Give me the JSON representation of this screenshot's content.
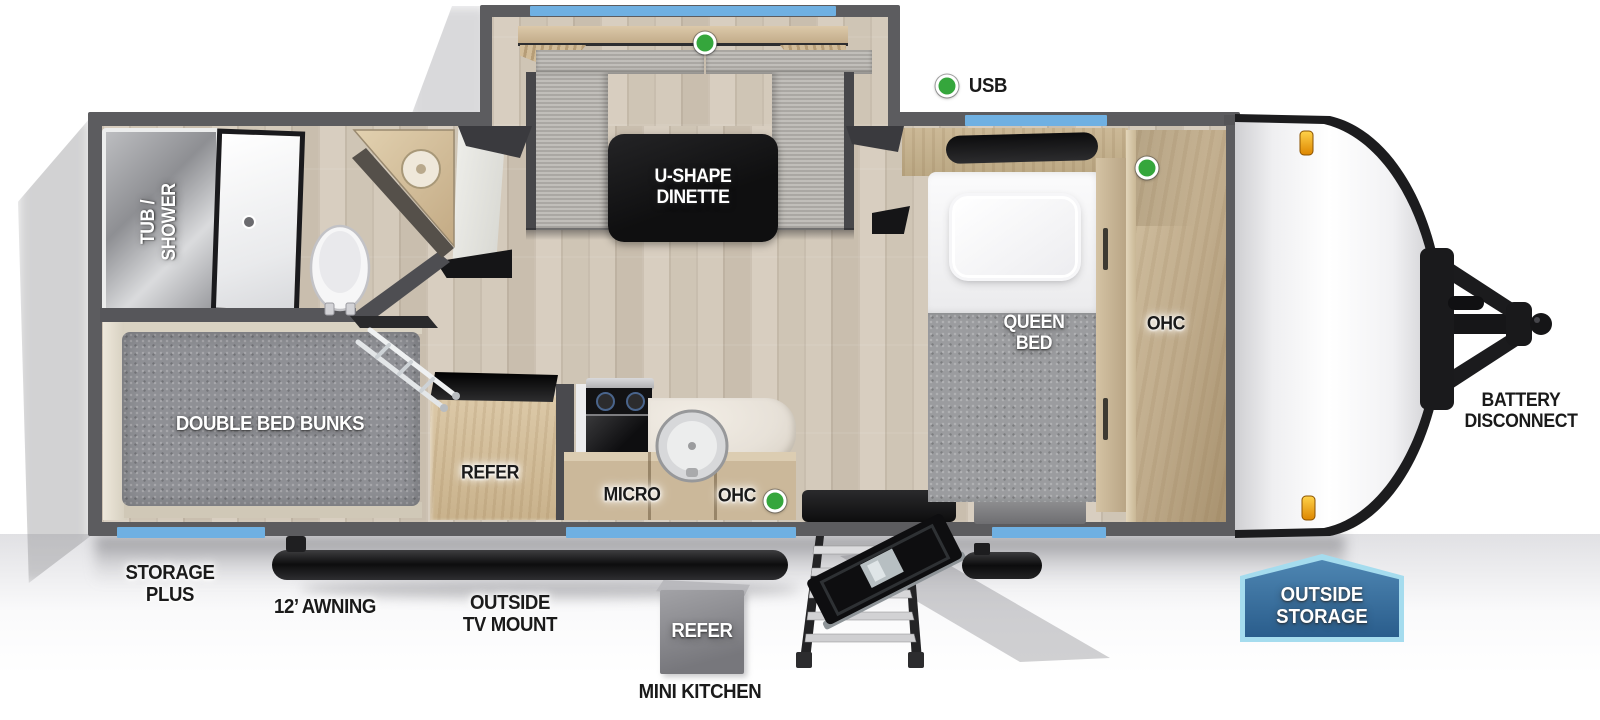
{
  "floorplan": {
    "title": "Travel trailer floorplan (top view)",
    "labels": {
      "usb": "USB",
      "u_shape_dinette": "U-SHAPE\nDINETTE",
      "tub_shower": "TUB /\nSHOWER",
      "queen_bed": "QUEEN\nBED",
      "ohc_bedroom": "OHC",
      "double_bed_bunks": "DOUBLE BED BUNKS",
      "refer_interior": "REFER",
      "micro": "MICRO",
      "ohc_kitchen": "OHC",
      "battery_disconnect": "BATTERY\nDISCONNECT",
      "storage_plus": "STORAGE\nPLUS",
      "awning": "12’ AWNING",
      "outside_tv_mount": "OUTSIDE\nTV MOUNT",
      "refer_outside": "REFER",
      "mini_kitchen": "MINI KITCHEN",
      "outside_storage": "OUTSIDE\nSTORAGE"
    },
    "indicators": {
      "style": "green-dot",
      "locations": [
        "dinette-table-usb",
        "usb-callout",
        "bedroom-ohc",
        "kitchen-ohc"
      ]
    },
    "colors": {
      "wall_gray": "#5c5c5f",
      "window_blue": "#6fb0e2",
      "indicator_green": "#35a63c",
      "table_black": "#171717",
      "badge_fill": "#2f6395",
      "badge_border": "#a5dcee",
      "marker_light_orange": "#f09a12"
    }
  }
}
